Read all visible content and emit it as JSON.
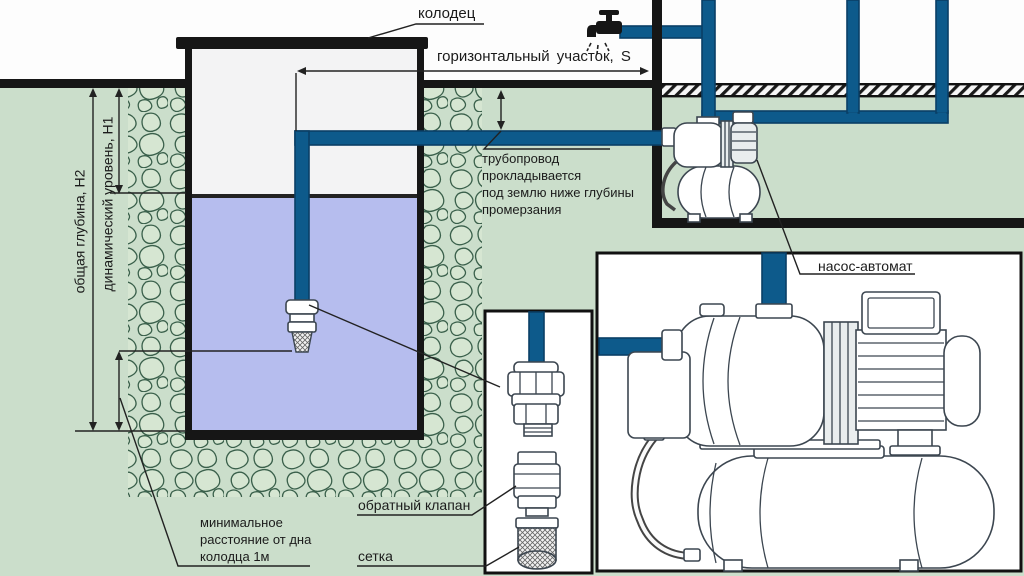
{
  "colors": {
    "background": "#cbdecb",
    "water": "#b6bdee",
    "pipe": "#0d5a8b",
    "pipe_edge": "#0a3f66",
    "well_interior": "#f3f3f4",
    "box_bg": "#ffffff",
    "stone_outline": "#3a604b",
    "stone_fill": "#d6e6d2"
  },
  "labels": {
    "well": "колодец",
    "horizontal_section": "горизонтальный участок, S",
    "pipeline_note": {
      "lines": [
        "трубопровод",
        "прокладывается",
        "под землю ниже глубины",
        "промерзания"
      ]
    },
    "total_depth": "общая глубина, Н2",
    "dynamic_level": "динамический уровень, Н1",
    "min_distance": {
      "lines": [
        "минимальное",
        "расстояние от дна",
        "колодца 1м"
      ]
    },
    "check_valve": "обратный клапан",
    "strainer": "сетка",
    "pump_station": "насос-автомат"
  },
  "icons": {
    "faucet": "faucet-icon",
    "well_intake": "well-intake-fitting"
  }
}
